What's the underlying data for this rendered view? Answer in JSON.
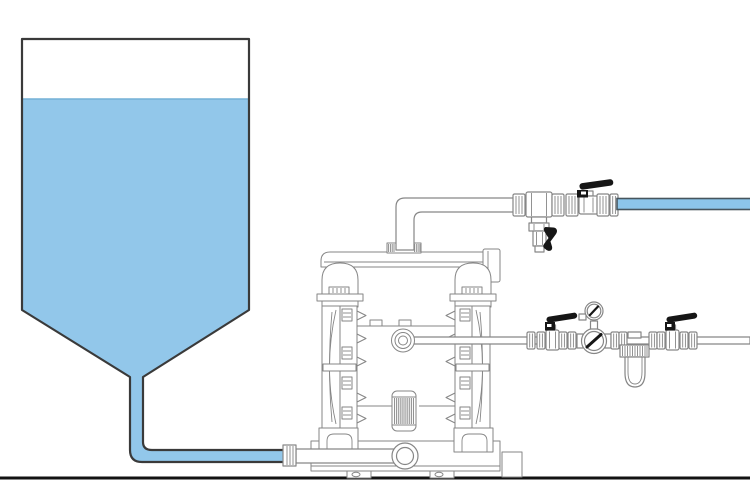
{
  "colors": {
    "background": "#ffffff",
    "liquid_blue": "#92c7ea",
    "hose_blue": "#8cc5ea",
    "surface_blue": "#74b0d6",
    "tank_outline": "#3a3a3a",
    "machine_line": "#868686",
    "hose_edge": "#47555e",
    "handle_black": "#161616",
    "ground_black": "#121212"
  },
  "components": [
    "supply-tank",
    "tank-liquid",
    "suction-pipe",
    "suction-pipe-union",
    "diaphragm-pump",
    "pump-discharge-manifold",
    "pump-air-dome-left",
    "pump-air-dome-right",
    "pump-chamber-left",
    "pump-chamber-right",
    "pump-air-inlet-fitting",
    "pump-muffler",
    "pump-base",
    "pump-inlet-elbow",
    "discharge-pipe",
    "discharge-tee",
    "drain-valve",
    "discharge-ball-valve",
    "discharge-hose",
    "air-supply-line",
    "air-ball-valve-upstream",
    "air-pressure-gauge",
    "air-regulator",
    "air-filter-bowl",
    "air-ball-valve-downstream",
    "ground-line"
  ]
}
